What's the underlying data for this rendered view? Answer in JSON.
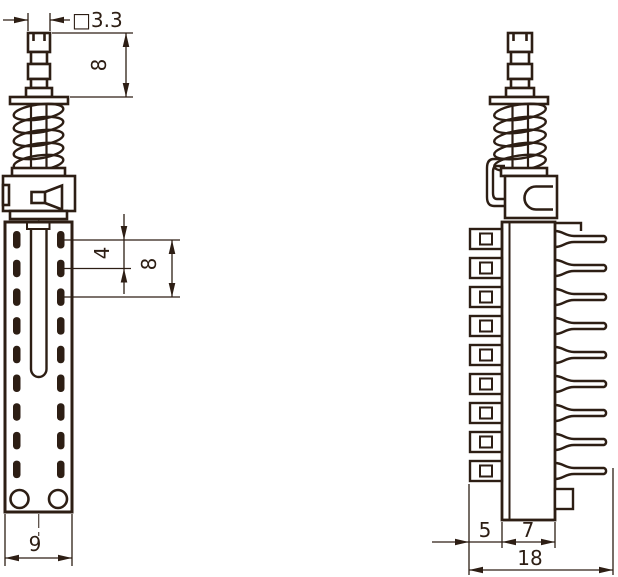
{
  "drawing": {
    "type": "technical-drawing",
    "background_color": "#ffffff",
    "ink_color": "#2d1e14",
    "views": {
      "front_view": "spring-plunger front view",
      "side_view": "spring-plunger side view with terminal pins"
    },
    "dimensions": {
      "plunger_square_width": "□3.3",
      "plunger_height": "8",
      "slot_pitch": "4",
      "slot_pitch_double": "8",
      "body_width": "9",
      "clip_depth": "5",
      "body_depth": "7",
      "overall_depth": "18"
    }
  }
}
